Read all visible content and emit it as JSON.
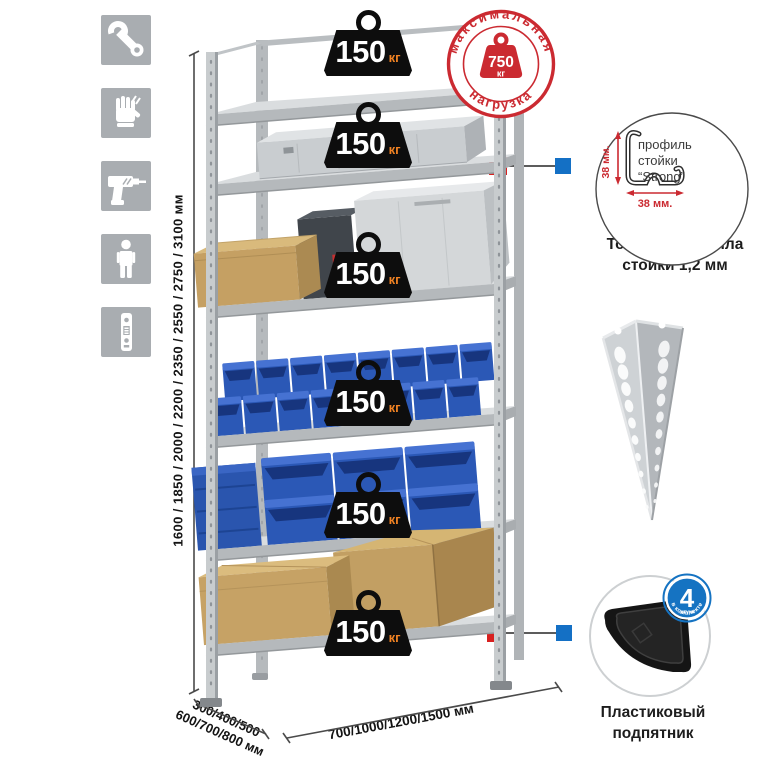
{
  "page": {
    "background": "#ffffff"
  },
  "side_icons": [
    {
      "name": "wrench"
    },
    {
      "name": "gloves"
    },
    {
      "name": "drill"
    },
    {
      "name": "person"
    },
    {
      "name": "post-profile"
    }
  ],
  "rack": {
    "shelf_count": 6,
    "badge": {
      "value": "150",
      "unit": "кг"
    }
  },
  "stamp": {
    "arc_top": "максимальная",
    "arc_bottom": "нагрузка",
    "value": "750",
    "unit": "кг"
  },
  "dims": {
    "height": "1600 / 1850 / 2000 / 2200 / 2350 / 2550 / 2750 / 3100 мм",
    "depth1": "300/400/500",
    "depth2": "600/700/800 мм",
    "width": "700/1000/1200/1500 мм"
  },
  "profile": {
    "dim_v": "38 мм.",
    "dim_h": "38 мм.",
    "l1": "профиль",
    "l2": "стойки",
    "l3": "“Strong”",
    "cap1": "Толщина металла",
    "cap2": "стойки 1,2 мм"
  },
  "foot": {
    "num": "4",
    "word": "штуки",
    "arc": "в комплекте",
    "cap1": "Пластиковый",
    "cap2": "подпятник"
  },
  "colors": {
    "accent_red": "#cb2a31",
    "accent_blue": "#1573c2",
    "bin_blue": "#2b58b6",
    "metal_gray": "#c8ccce",
    "badge_black": "#0d0d0d",
    "badge_unit_orange": "#f08223"
  }
}
